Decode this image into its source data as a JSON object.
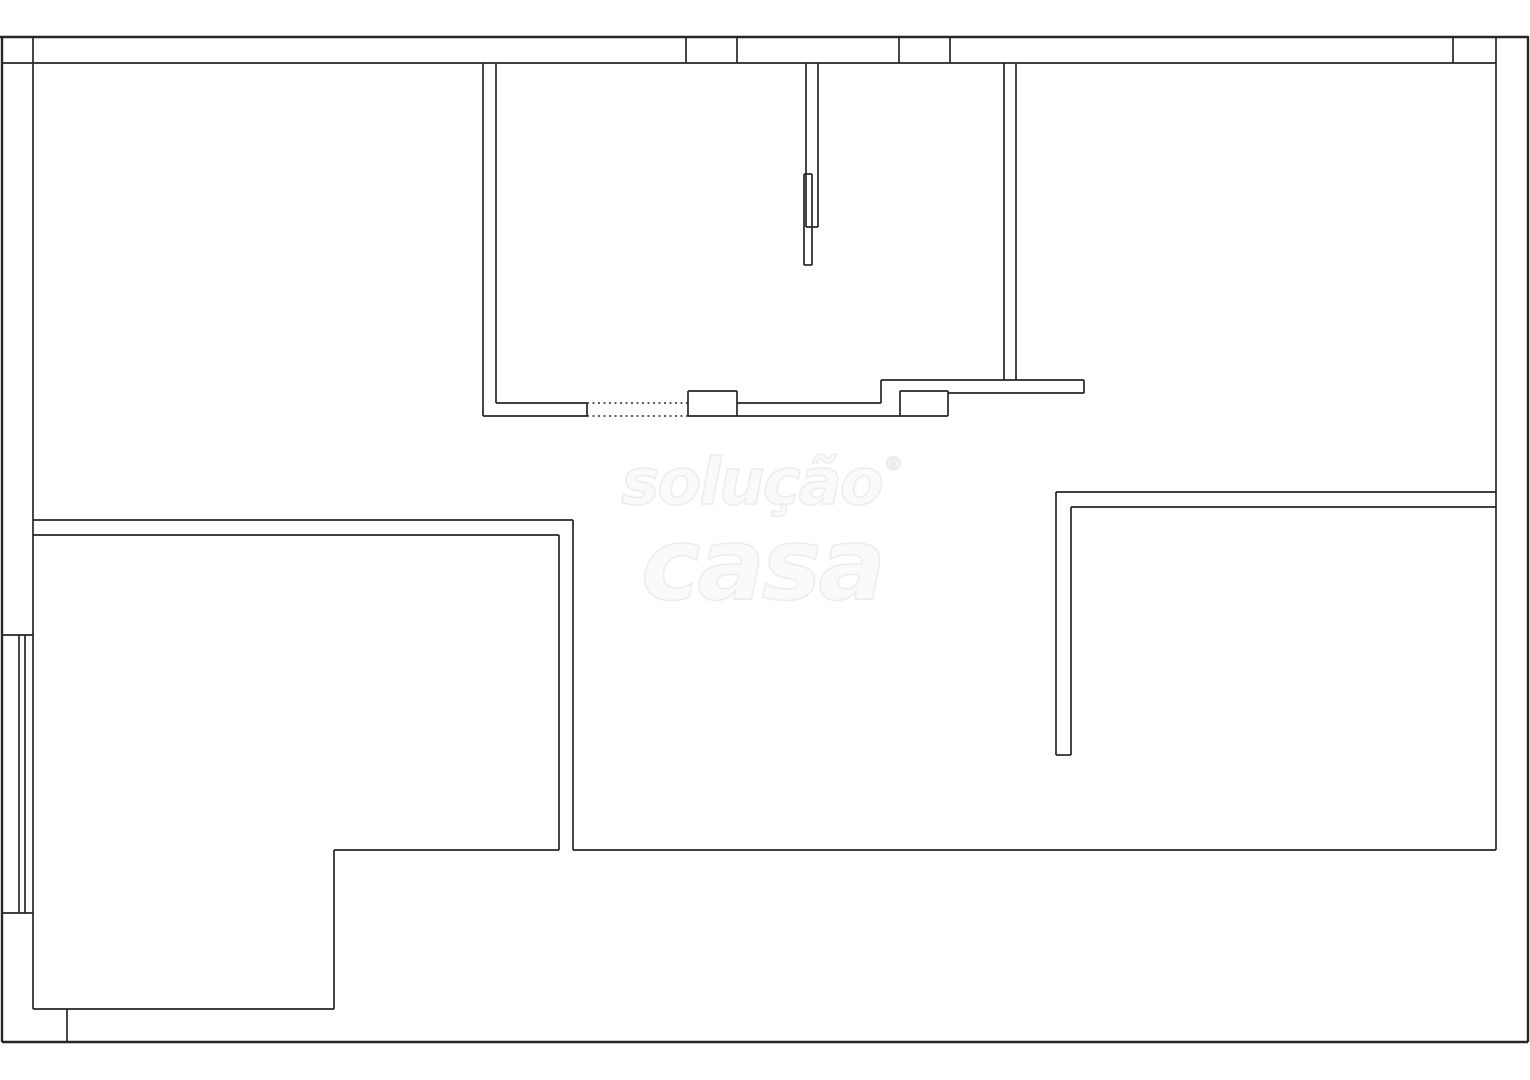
{
  "watermark": {
    "line1": "solução",
    "registered": "®",
    "line2": "casa",
    "fill_color": "#fafafa",
    "outline_color": "#ececec"
  },
  "plan": {
    "canvas_width": 1530,
    "canvas_height": 1080,
    "background_color": "#ffffff",
    "line_color": "#262626",
    "outer_line_width": 2.4,
    "wall_line_width": 1.7,
    "dash_pattern": "2 3.5",
    "walls": [
      {
        "n": "outer-top-wall-line",
        "x1": 0,
        "y1": 37,
        "x2": 1529,
        "y2": 37,
        "w": 2.4
      },
      {
        "n": "outer-left-wall-line",
        "x1": 2,
        "y1": 37,
        "x2": 2,
        "y2": 1042,
        "w": 2.4
      },
      {
        "n": "outer-bottom-boundary-line",
        "x1": 2,
        "y1": 1042,
        "x2": 1528,
        "y2": 1042,
        "w": 2.4
      },
      {
        "n": "outer-right-wall-line",
        "x1": 1528,
        "y1": 37,
        "x2": 1528,
        "y2": 1042,
        "w": 2.4
      },
      {
        "n": "top-wall-inner-line",
        "x1": 2,
        "y1": 63,
        "x2": 1496,
        "y2": 63
      },
      {
        "n": "top-wall-window-tick-a",
        "x1": 686,
        "y1": 37,
        "x2": 686,
        "y2": 63
      },
      {
        "n": "top-wall-window-tick-b",
        "x1": 737,
        "y1": 37,
        "x2": 737,
        "y2": 63
      },
      {
        "n": "top-wall-window-tick-c",
        "x1": 899,
        "y1": 37,
        "x2": 899,
        "y2": 63
      },
      {
        "n": "top-wall-window-tick-d",
        "x1": 950,
        "y1": 37,
        "x2": 950,
        "y2": 63
      },
      {
        "n": "top-wall-window-tick-e",
        "x1": 1453,
        "y1": 37,
        "x2": 1453,
        "y2": 63
      },
      {
        "n": "left-wall-inner-line",
        "x1": 33,
        "y1": 37,
        "x2": 33,
        "y2": 1009
      },
      {
        "n": "left-window-top-cap",
        "x1": 2,
        "y1": 635,
        "x2": 33,
        "y2": 635
      },
      {
        "n": "left-window-bottom-cap",
        "x1": 2,
        "y1": 913,
        "x2": 33,
        "y2": 913
      },
      {
        "n": "left-window-pane-outer",
        "x1": 19,
        "y1": 635,
        "x2": 19,
        "y2": 913
      },
      {
        "n": "left-window-pane-inner",
        "x1": 25,
        "y1": 635,
        "x2": 25,
        "y2": 913
      },
      {
        "n": "right-wall-inner-line",
        "x1": 1496,
        "y1": 37,
        "x2": 1496,
        "y2": 850
      },
      {
        "n": "kitchen-left-wall-outer",
        "x1": 483,
        "y1": 63,
        "x2": 483,
        "y2": 416
      },
      {
        "n": "kitchen-left-wall-inner",
        "x1": 496,
        "y1": 63,
        "x2": 496,
        "y2": 403
      },
      {
        "n": "kitchen-wall-arm-top",
        "x1": 496,
        "y1": 403,
        "x2": 587,
        "y2": 403
      },
      {
        "n": "kitchen-wall-arm-bottom",
        "x1": 483,
        "y1": 416,
        "x2": 587,
        "y2": 416
      },
      {
        "n": "kitchen-wall-end-cap",
        "x1": 587,
        "y1": 403,
        "x2": 587,
        "y2": 416
      },
      {
        "n": "kitchen-opening-dashed-top",
        "x1": 587,
        "y1": 403,
        "x2": 688,
        "y2": 403,
        "d": true,
        "w": 1.4
      },
      {
        "n": "kitchen-opening-dashed-bottom",
        "x1": 587,
        "y1": 416,
        "x2": 688,
        "y2": 416,
        "d": true,
        "w": 1.4
      },
      {
        "n": "pillar-a-top",
        "x1": 688,
        "y1": 391,
        "x2": 737,
        "y2": 391
      },
      {
        "n": "pillar-a-left",
        "x1": 688,
        "y1": 391,
        "x2": 688,
        "y2": 416
      },
      {
        "n": "pillar-a-right",
        "x1": 737,
        "y1": 391,
        "x2": 737,
        "y2": 416
      },
      {
        "n": "pillar-a-bottom",
        "x1": 688,
        "y1": 416,
        "x2": 737,
        "y2": 416
      },
      {
        "n": "counter-lower-edge",
        "x1": 737,
        "y1": 403,
        "x2": 881,
        "y2": 403
      },
      {
        "n": "counter-step",
        "x1": 881,
        "y1": 380,
        "x2": 881,
        "y2": 403
      },
      {
        "n": "counter-upper-edge",
        "x1": 881,
        "y1": 380,
        "x2": 1084,
        "y2": 380
      },
      {
        "n": "counter-inner-edge",
        "x1": 948,
        "y1": 393,
        "x2": 1084,
        "y2": 393
      },
      {
        "n": "counter-end-cap",
        "x1": 1084,
        "y1": 380,
        "x2": 1084,
        "y2": 393
      },
      {
        "n": "counter-bottom-edge",
        "x1": 737,
        "y1": 416,
        "x2": 900,
        "y2": 416
      },
      {
        "n": "pillar-b-top",
        "x1": 900,
        "y1": 391,
        "x2": 948,
        "y2": 391
      },
      {
        "n": "pillar-b-left",
        "x1": 900,
        "y1": 391,
        "x2": 900,
        "y2": 416
      },
      {
        "n": "pillar-b-right",
        "x1": 948,
        "y1": 391,
        "x2": 948,
        "y2": 416
      },
      {
        "n": "pillar-b-bottom",
        "x1": 900,
        "y1": 416,
        "x2": 948,
        "y2": 416
      },
      {
        "n": "center-partition-left",
        "x1": 806,
        "y1": 63,
        "x2": 806,
        "y2": 227
      },
      {
        "n": "center-partition-right",
        "x1": 818,
        "y1": 63,
        "x2": 818,
        "y2": 227
      },
      {
        "n": "center-partition-cap",
        "x1": 806,
        "y1": 227,
        "x2": 818,
        "y2": 227
      },
      {
        "n": "door-leaf-left",
        "x1": 804,
        "y1": 174,
        "x2": 804,
        "y2": 265
      },
      {
        "n": "door-leaf-right",
        "x1": 812,
        "y1": 174,
        "x2": 812,
        "y2": 265
      },
      {
        "n": "door-leaf-top",
        "x1": 804,
        "y1": 174,
        "x2": 812,
        "y2": 174
      },
      {
        "n": "door-leaf-bottom",
        "x1": 804,
        "y1": 265,
        "x2": 812,
        "y2": 265
      },
      {
        "n": "kitchen-right-wall-outer",
        "x1": 1004,
        "y1": 63,
        "x2": 1004,
        "y2": 380
      },
      {
        "n": "kitchen-right-wall-inner",
        "x1": 1016,
        "y1": 63,
        "x2": 1016,
        "y2": 380
      },
      {
        "n": "left-room-top-wall-outer",
        "x1": 33,
        "y1": 520,
        "x2": 573,
        "y2": 520
      },
      {
        "n": "left-room-top-wall-inner",
        "x1": 33,
        "y1": 535,
        "x2": 559,
        "y2": 535
      },
      {
        "n": "left-room-right-wall-outer",
        "x1": 573,
        "y1": 520,
        "x2": 573,
        "y2": 850
      },
      {
        "n": "left-room-right-wall-inner",
        "x1": 559,
        "y1": 535,
        "x2": 559,
        "y2": 850
      },
      {
        "n": "left-room-bottom-wall",
        "x1": 334,
        "y1": 850,
        "x2": 559,
        "y2": 850
      },
      {
        "n": "hall-bottom-wall",
        "x1": 573,
        "y1": 850,
        "x2": 1496,
        "y2": 850
      },
      {
        "n": "left-room-step-wall",
        "x1": 334,
        "y1": 850,
        "x2": 334,
        "y2": 1009
      },
      {
        "n": "left-room-lower-bottom-wall",
        "x1": 33,
        "y1": 1009,
        "x2": 334,
        "y2": 1009
      },
      {
        "n": "bottom-wall-door-tick",
        "x1": 67,
        "y1": 1009,
        "x2": 67,
        "y2": 1042
      },
      {
        "n": "bedroom-top-wall-outer",
        "x1": 1056,
        "y1": 492,
        "x2": 1496,
        "y2": 492
      },
      {
        "n": "bedroom-top-wall-inner",
        "x1": 1071,
        "y1": 507,
        "x2": 1496,
        "y2": 507
      },
      {
        "n": "bedroom-left-wall-outer",
        "x1": 1056,
        "y1": 492,
        "x2": 1056,
        "y2": 755
      },
      {
        "n": "bedroom-left-wall-inner",
        "x1": 1071,
        "y1": 507,
        "x2": 1071,
        "y2": 755
      },
      {
        "n": "bedroom-wall-end-cap",
        "x1": 1056,
        "y1": 755,
        "x2": 1071,
        "y2": 755
      }
    ]
  }
}
